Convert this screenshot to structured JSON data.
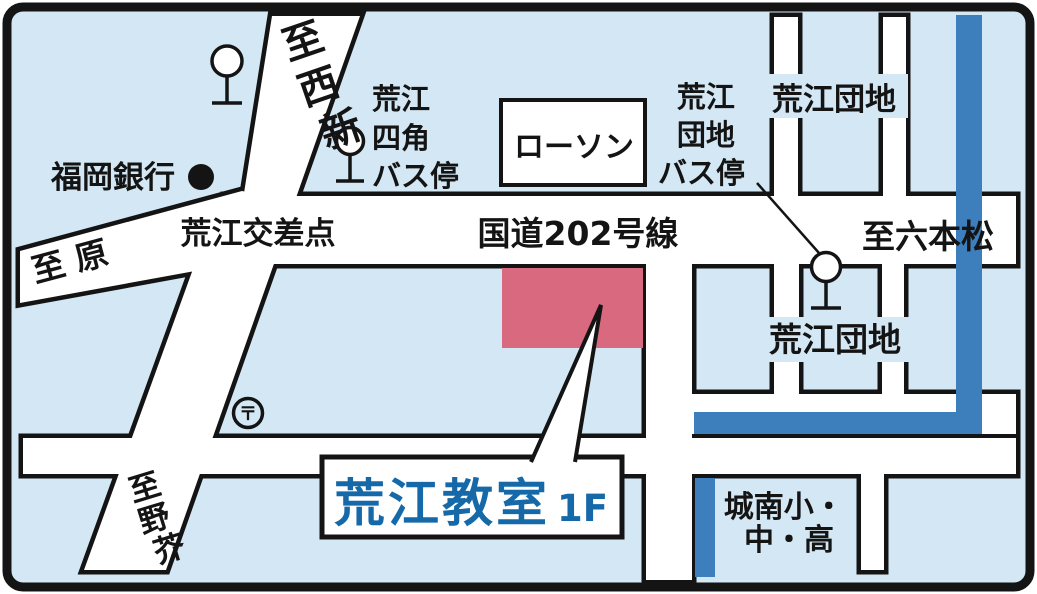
{
  "map": {
    "title_box": {
      "name": "荒江教室",
      "floor": "1F"
    },
    "roads": {
      "route": "国道202号線",
      "intersection": "荒江交差点",
      "to_hara": "至 原",
      "to_ropponmatsu": "至六本松",
      "to_nishijin": [
        "至",
        "西",
        "新"
      ],
      "to_noke": [
        "至",
        "野",
        "芥"
      ]
    },
    "places": {
      "bank": "福岡銀行",
      "lawson": "ローソン",
      "danchi_top": "荒江団地",
      "danchi_lower": "荒江団地",
      "school_line1": "城南小・",
      "school_line2": "中・高",
      "post_mark": "〒"
    },
    "bus_stops": {
      "yonkaku": [
        "荒江",
        "四角",
        "バス停"
      ],
      "danchi": [
        "荒江",
        "団地",
        "バス停"
      ]
    },
    "colors": {
      "background": "#d3e7f4",
      "road": "#ffffff",
      "outline": "#141414",
      "river": "#3d7ebc",
      "building": "#d9697f",
      "title_text": "#1569a9"
    }
  }
}
